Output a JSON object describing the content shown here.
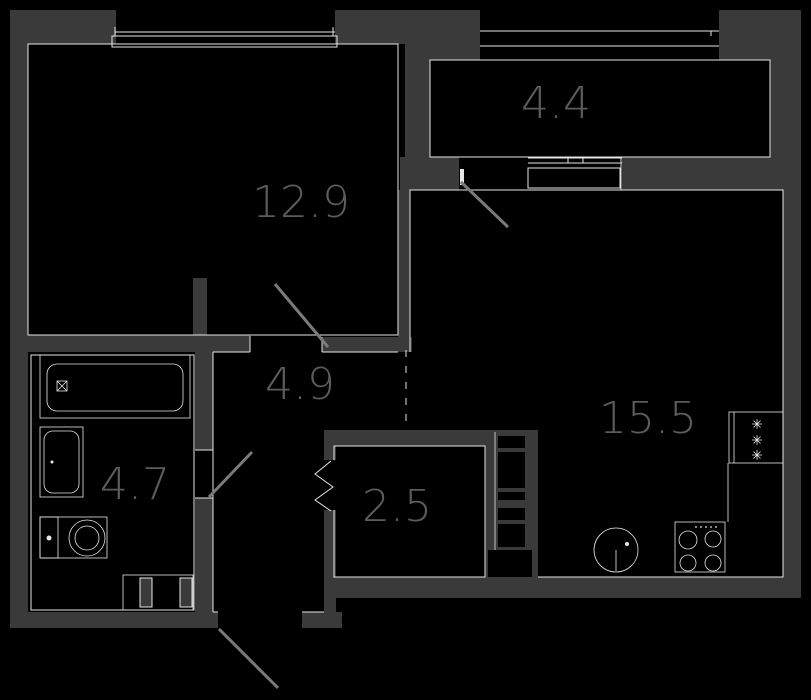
{
  "plan": {
    "type": "apartment-floor-plan",
    "colors": {
      "background": "#000000",
      "wall": "#3a3a3a",
      "line": "#e6e6e6",
      "label": "#5c5c5c",
      "door": "#7a7a7a"
    },
    "rooms": [
      {
        "name": "living-room",
        "area_label": "12.9"
      },
      {
        "name": "balcony",
        "area_label": "4.4"
      },
      {
        "name": "hallway",
        "area_label": "4.9"
      },
      {
        "name": "bathroom",
        "area_label": "4.7"
      },
      {
        "name": "closet",
        "area_label": "2.5"
      },
      {
        "name": "kitchen-living-room",
        "area_label": "15.5"
      }
    ],
    "fixtures": [
      "bathtub",
      "wash-basin",
      "washing-machine",
      "ventilation-duct",
      "wardrobe",
      "kitchen-sink",
      "stove",
      "refrigerator"
    ]
  }
}
